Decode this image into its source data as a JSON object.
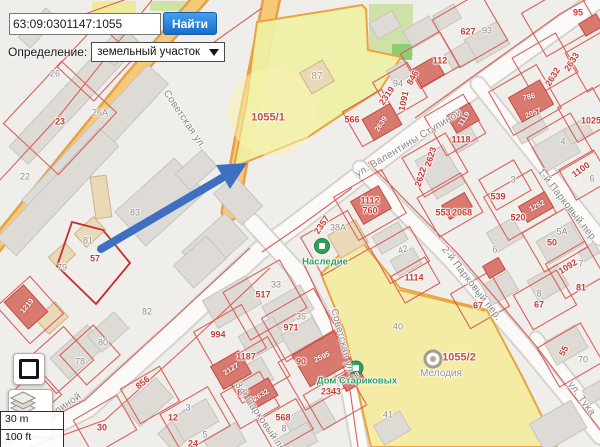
{
  "ui": {
    "search": {
      "value": "63:09:0301147:1055",
      "button_label": "Найти"
    },
    "definition": {
      "label": "Определение:",
      "value": "земельный участок"
    },
    "scalebar": {
      "metric": "30 m",
      "imperial": "100 ft"
    }
  },
  "colors": {
    "accent_blue": "#1f6fd0",
    "arrow_blue": "#3f6fc1",
    "highlight_yellow": "#eff0a4",
    "parcel_red": "#d8615c",
    "road_orange": "#f6c878",
    "poi_green": "#2f9e60"
  },
  "map": {
    "highlighted_parcels": [
      "1055/1",
      "1055/2"
    ],
    "parcel_labels": [
      [
        "95",
        578,
        13,
        0,
        "red"
      ],
      [
        "627",
        468,
        32,
        0,
        "red"
      ],
      [
        "93",
        487,
        31,
        0,
        "gray"
      ],
      [
        "112",
        440,
        61,
        0,
        "red"
      ],
      [
        "94",
        398,
        84,
        0,
        "gray"
      ],
      [
        "846",
        413,
        78,
        -62,
        "red"
      ],
      [
        "1091",
        404,
        101,
        -78,
        "red"
      ],
      [
        "2319",
        387,
        96,
        -56,
        "red"
      ],
      [
        "566",
        352,
        120,
        0,
        "red"
      ],
      [
        "2639",
        381,
        124,
        -56,
        "white"
      ],
      [
        "2633",
        572,
        62,
        -58,
        "red"
      ],
      [
        "2632",
        553,
        77,
        -58,
        "red"
      ],
      [
        "786",
        529,
        97,
        -12,
        "white"
      ],
      [
        "2057",
        533,
        113,
        -22,
        "white"
      ],
      [
        "1025",
        591,
        121,
        0,
        "red"
      ],
      [
        "4",
        563,
        142,
        0,
        "gray"
      ],
      [
        "1100",
        581,
        170,
        -36,
        "red"
      ],
      [
        "6",
        592,
        179,
        0,
        "gray"
      ],
      [
        "1118",
        461,
        140,
        0,
        "red"
      ],
      [
        "1119",
        464,
        119,
        -58,
        "white"
      ],
      [
        "2623",
        431,
        157,
        -72,
        "red"
      ],
      [
        "2622",
        421,
        177,
        -72,
        "red"
      ],
      [
        "1112",
        370,
        201,
        0,
        "red"
      ],
      [
        "760",
        370,
        211,
        0,
        "red"
      ],
      [
        "553",
        443,
        213,
        0,
        "red"
      ],
      [
        "2068",
        462,
        213,
        0,
        "red"
      ],
      [
        "2357",
        322,
        225,
        -56,
        "red"
      ],
      [
        "38А",
        338,
        228,
        0,
        "gray"
      ],
      [
        "42",
        403,
        250,
        -20,
        "gray"
      ],
      [
        "1114",
        414,
        278,
        0,
        "red"
      ],
      [
        "3",
        513,
        180,
        0,
        "gray"
      ],
      [
        "539",
        498,
        197,
        0,
        "red"
      ],
      [
        "520",
        518,
        218,
        0,
        "red"
      ],
      [
        "1252",
        537,
        206,
        -28,
        "white"
      ],
      [
        "5А",
        562,
        232,
        0,
        "gray"
      ],
      [
        "50",
        552,
        243,
        0,
        "red"
      ],
      [
        "6",
        495,
        250,
        0,
        "gray"
      ],
      [
        "1092",
        568,
        267,
        -32,
        "red"
      ],
      [
        "7",
        581,
        264,
        0,
        "gray"
      ],
      [
        "81",
        581,
        288,
        0,
        "red"
      ],
      [
        "8",
        539,
        294,
        0,
        "gray"
      ],
      [
        "67",
        539,
        305,
        0,
        "red"
      ],
      [
        "8",
        477,
        295,
        0,
        "gray"
      ],
      [
        "67",
        478,
        306,
        0,
        "red"
      ],
      [
        "55",
        564,
        351,
        -62,
        "red"
      ],
      [
        "70",
        583,
        360,
        0,
        "gray"
      ],
      [
        "40",
        398,
        327,
        0,
        "gray"
      ],
      [
        "41",
        388,
        415,
        0,
        "gray"
      ],
      [
        "33",
        276,
        285,
        0,
        "gray"
      ],
      [
        "517",
        263,
        295,
        0,
        "red"
      ],
      [
        "35",
        301,
        317,
        0,
        "gray"
      ],
      [
        "971",
        291,
        328,
        0,
        "red"
      ],
      [
        "994",
        218,
        335,
        0,
        "red"
      ],
      [
        "1187",
        246,
        357,
        0,
        "red"
      ],
      [
        "2127",
        231,
        369,
        -32,
        "white"
      ],
      [
        "90",
        301,
        362,
        0,
        "red"
      ],
      [
        "2595",
        322,
        357,
        -26,
        "white"
      ],
      [
        "2343",
        331,
        392,
        0,
        "red"
      ],
      [
        "1539",
        352,
        378,
        -30,
        "white"
      ],
      [
        "87",
        317,
        77,
        0,
        "khaki"
      ],
      [
        "26",
        55,
        74,
        0,
        "gray"
      ],
      [
        "26А",
        100,
        113,
        0,
        "gray"
      ],
      [
        "23",
        60,
        122,
        0,
        "red"
      ],
      [
        "22",
        25,
        177,
        0,
        "gray"
      ],
      [
        "83",
        135,
        213,
        0,
        "gray"
      ],
      [
        "81",
        88,
        241,
        0,
        "gray"
      ],
      [
        "79",
        62,
        268,
        0,
        "gray"
      ],
      [
        "57",
        95,
        259,
        0,
        "red"
      ],
      [
        "82",
        147,
        312,
        0,
        "gray"
      ],
      [
        "80",
        103,
        343,
        0,
        "gray"
      ],
      [
        "78",
        80,
        362,
        0,
        "gray"
      ],
      [
        "71",
        33,
        380,
        0,
        "red"
      ],
      [
        "1219",
        27,
        306,
        -50,
        "white"
      ],
      [
        "856",
        143,
        383,
        -38,
        "red"
      ],
      [
        "30",
        102,
        428,
        0,
        "red"
      ],
      [
        "12",
        173,
        418,
        0,
        "red"
      ],
      [
        "3",
        188,
        408,
        0,
        "gray"
      ],
      [
        "5",
        205,
        435,
        0,
        "gray"
      ],
      [
        "24",
        193,
        444,
        0,
        "red"
      ],
      [
        "87",
        242,
        393,
        0,
        "red"
      ],
      [
        "2632",
        261,
        395,
        -32,
        "white"
      ],
      [
        "568",
        283,
        418,
        0,
        "red"
      ],
      [
        "8",
        284,
        429,
        0,
        "gray"
      ],
      [
        "1055/1",
        268,
        118,
        0,
        "brown"
      ],
      [
        "1055/2",
        459,
        358,
        0,
        "brown"
      ]
    ],
    "street_labels": [
      [
        "Советская ул.",
        184,
        120,
        56,
        "street"
      ],
      [
        "Советская ул.",
        342,
        342,
        75,
        "street"
      ],
      [
        "ул. Валентины Ступиной",
        409,
        144,
        -31,
        "street"
      ],
      [
        "ул. Валентины Ступиной",
        30,
        430,
        -34,
        "street"
      ],
      [
        "1-й Парковый пер.",
        567,
        206,
        52,
        "street"
      ],
      [
        "2-й Парковый пер.",
        471,
        284,
        52,
        "street"
      ],
      [
        "3-й Парковый пер.",
        262,
        421,
        56,
        "street"
      ],
      [
        "ул. Тука",
        581,
        399,
        54,
        "street"
      ]
    ],
    "poi_labels": [
      [
        "Наследие",
        325,
        262,
        0,
        "green"
      ],
      [
        "Дом Стариковых",
        357,
        381,
        0,
        "green"
      ],
      [
        "Мелодия",
        441,
        374,
        0,
        "graypoi"
      ]
    ]
  }
}
